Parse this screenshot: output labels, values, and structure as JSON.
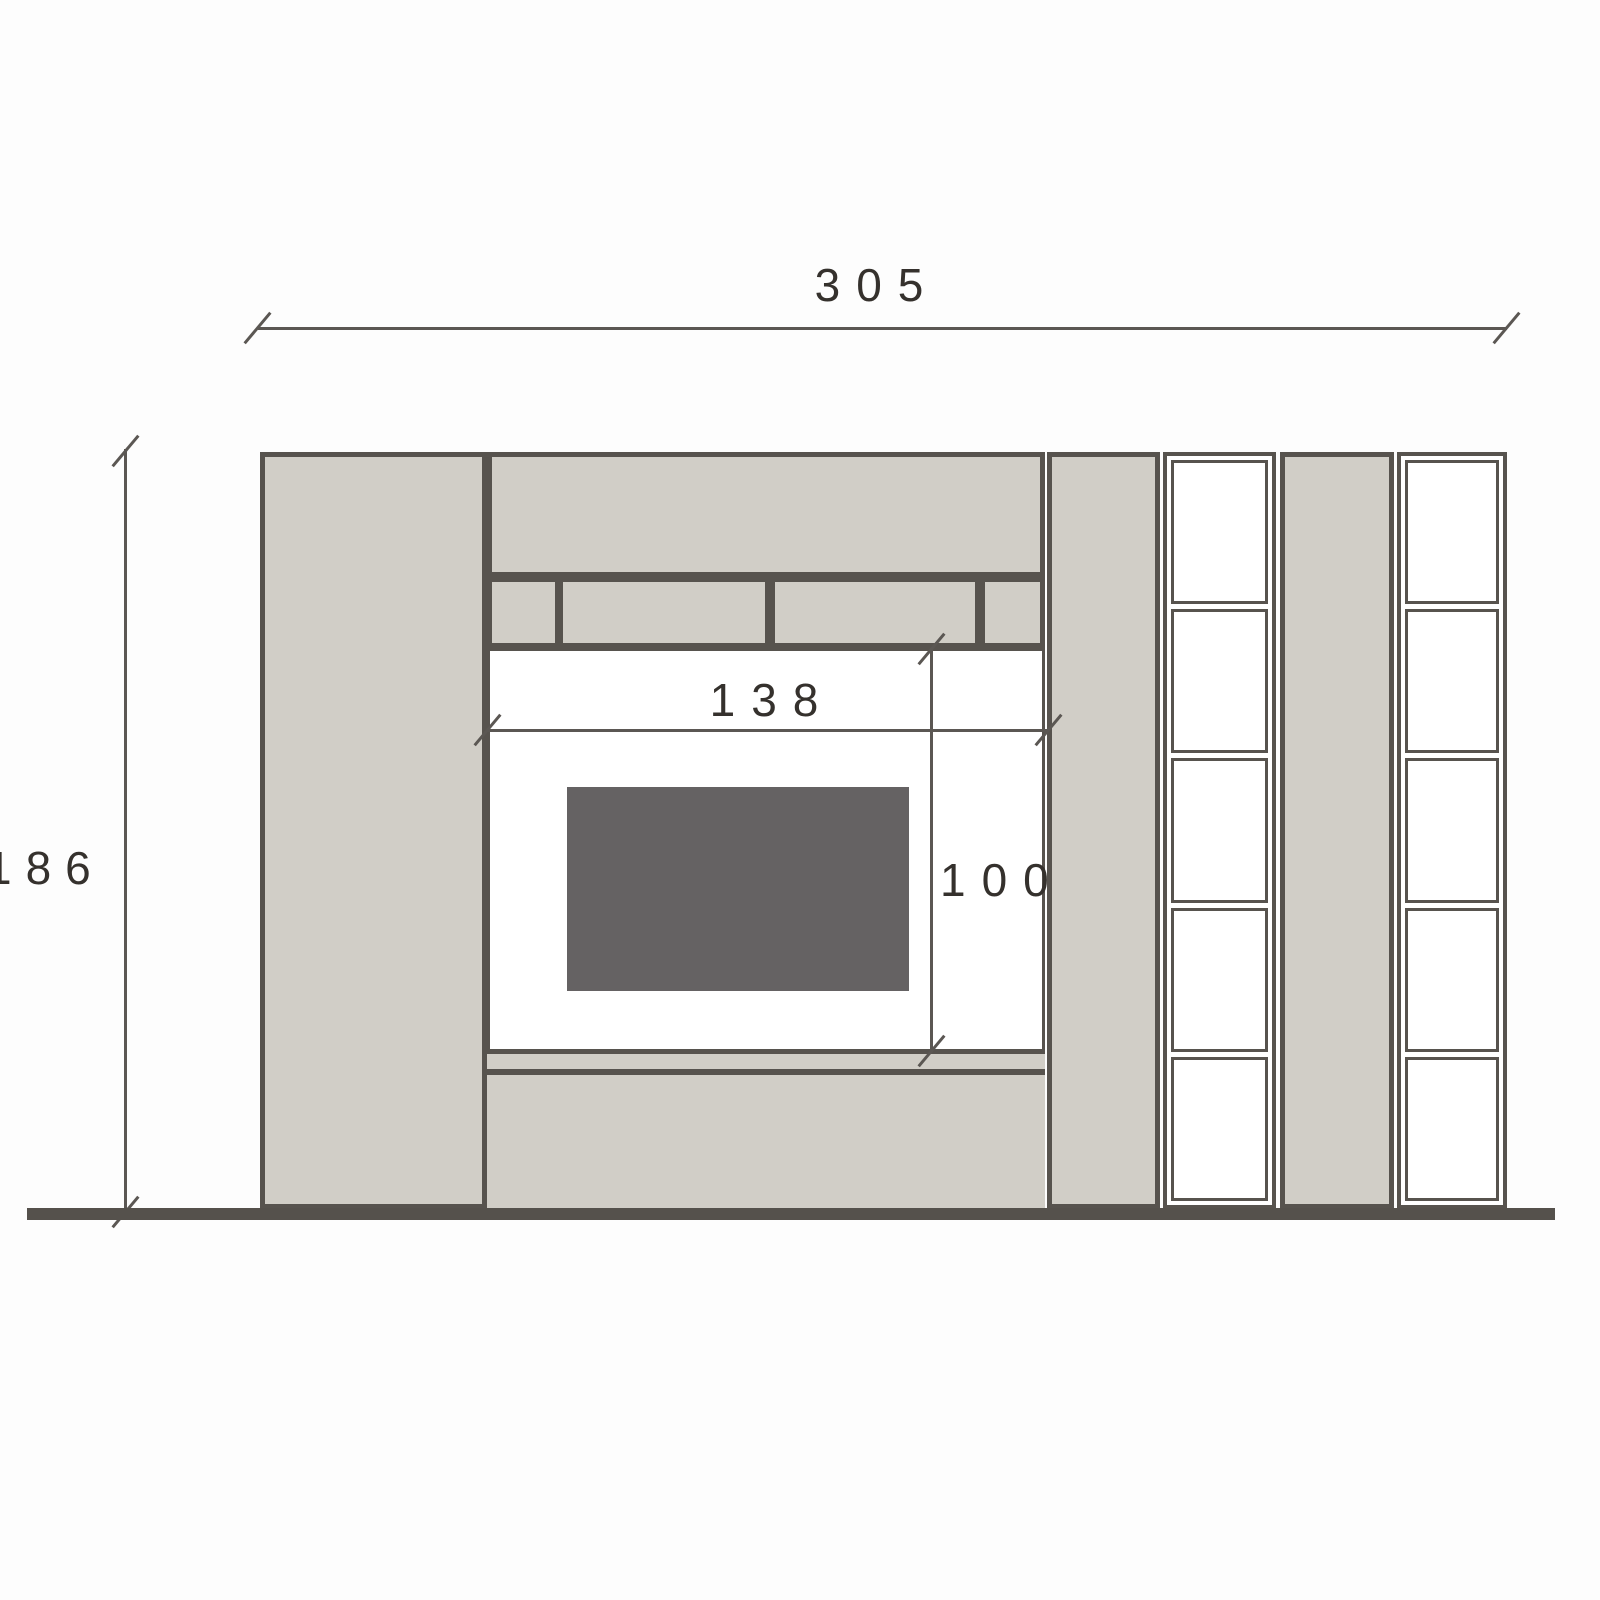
{
  "drawing": {
    "title": "wall-unit-front-elevation",
    "type": "furniture technical drawing",
    "background_color": "#fdfdfd",
    "colors": {
      "panel_fill": "#d1cec7",
      "outline": "#57534e",
      "tv_fill": "#656263",
      "ground_line": "#55514c",
      "dimension_line": "#5b5753",
      "dimension_text": "#35312d"
    },
    "dimensions": {
      "overall_width": {
        "label": "305",
        "orientation": "horizontal",
        "position": "top"
      },
      "overall_height": {
        "label": "186",
        "orientation": "vertical",
        "position": "left",
        "note": "first digit clipped at image edge"
      },
      "niche_width": {
        "label": "138",
        "orientation": "horizontal",
        "position": "above tv niche"
      },
      "niche_height": {
        "label": "100",
        "orientation": "vertical",
        "position": "right side of tv niche"
      }
    },
    "components": {
      "left_tall_cabinet": {
        "fill": "beige"
      },
      "top_cabinet": {
        "fill": "beige"
      },
      "compartment_row": {
        "cells": 4,
        "fill": "beige",
        "note": "narrow-wide-wide-narrow"
      },
      "tv_niche": {
        "fill": "white",
        "contains": "tv screen"
      },
      "tv_screen": {
        "fill": "dark gray"
      },
      "base_cabinet": {
        "fill": "beige"
      },
      "side_panel_a": {
        "fill": "beige"
      },
      "open_shelf_unit_a": {
        "cells": 5,
        "fill": "white"
      },
      "side_panel_b": {
        "fill": "beige"
      },
      "open_shelf_unit_b": {
        "cells": 5,
        "fill": "white"
      },
      "ground_line": {
        "style": "thick dark horizontal line"
      }
    }
  }
}
